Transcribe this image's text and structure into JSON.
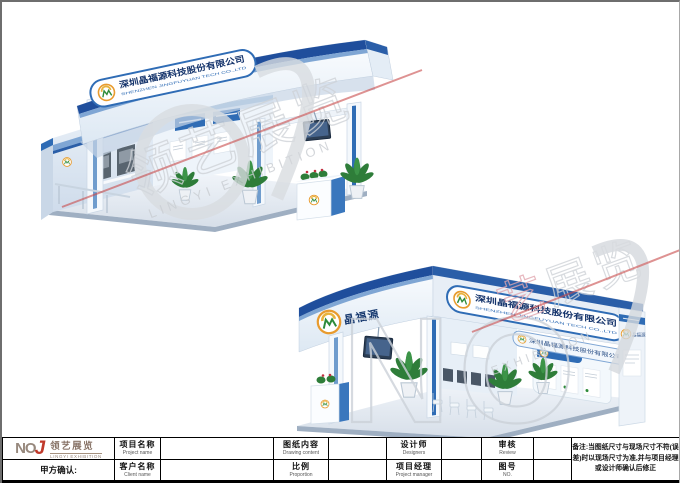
{
  "sheet": {
    "confirm_label": "甲方确认:",
    "note": "备注:当图纸尺寸与现场尺寸不符(误差)时以现场尺寸为准,并与项目经理或设计师确认后修正"
  },
  "logo": {
    "letters_no": "NO",
    "letter_j": "J",
    "cn": "领艺展览",
    "en": "LINGYI EXHIBITION"
  },
  "fields": {
    "project_name": {
      "cn": "项目名称",
      "en": "Project name",
      "value": ""
    },
    "drawing_content": {
      "cn": "图纸内容",
      "en": "Drawing content",
      "value": ""
    },
    "designer": {
      "cn": "设计师",
      "en": "Designers",
      "value": ""
    },
    "review": {
      "cn": "审核",
      "en": "Review",
      "value": ""
    },
    "client_name": {
      "cn": "客户名称",
      "en": "Client name",
      "value": ""
    },
    "proportion": {
      "cn": "比例",
      "en": "Proportion",
      "value": ""
    },
    "project_manager": {
      "cn": "项目经理",
      "en": "Project manager",
      "value": ""
    },
    "drawing_no": {
      "cn": "图号",
      "en": "NO.",
      "value": ""
    }
  },
  "booths": {
    "top": {
      "sign_cn": "深圳晶福源科技股份有限公司",
      "sign_en": "SHENZHEN JINGFUYUAN TECH CO.,LTD"
    },
    "bottom": {
      "brand": "晶福源",
      "sign_cn": "深圳晶福源科技股份有限公司",
      "sign_en": "SHENZHEN JINGFUYUAN TECH CO.,LTD",
      "inner_sign": "深圳晶福源科技股份有限公司",
      "panel_brand": "晶福源"
    }
  },
  "watermarks": {
    "top": {
      "cn": "领艺展览",
      "en": "LINGYI EXHIBITION"
    },
    "bottom": {
      "letters": "NO",
      "cn_first": "艺",
      "cn_rest": "展览",
      "en": "EXHIBITION"
    }
  },
  "colors": {
    "booth_blue": "#2f6cb5",
    "booth_dark_blue": "#1f4e9c",
    "logo_brown": "#8f7b6d",
    "logo_red": "#c0392b",
    "watermark_gray": "#d4d4d4",
    "watermark_red": "#c84a4a"
  }
}
